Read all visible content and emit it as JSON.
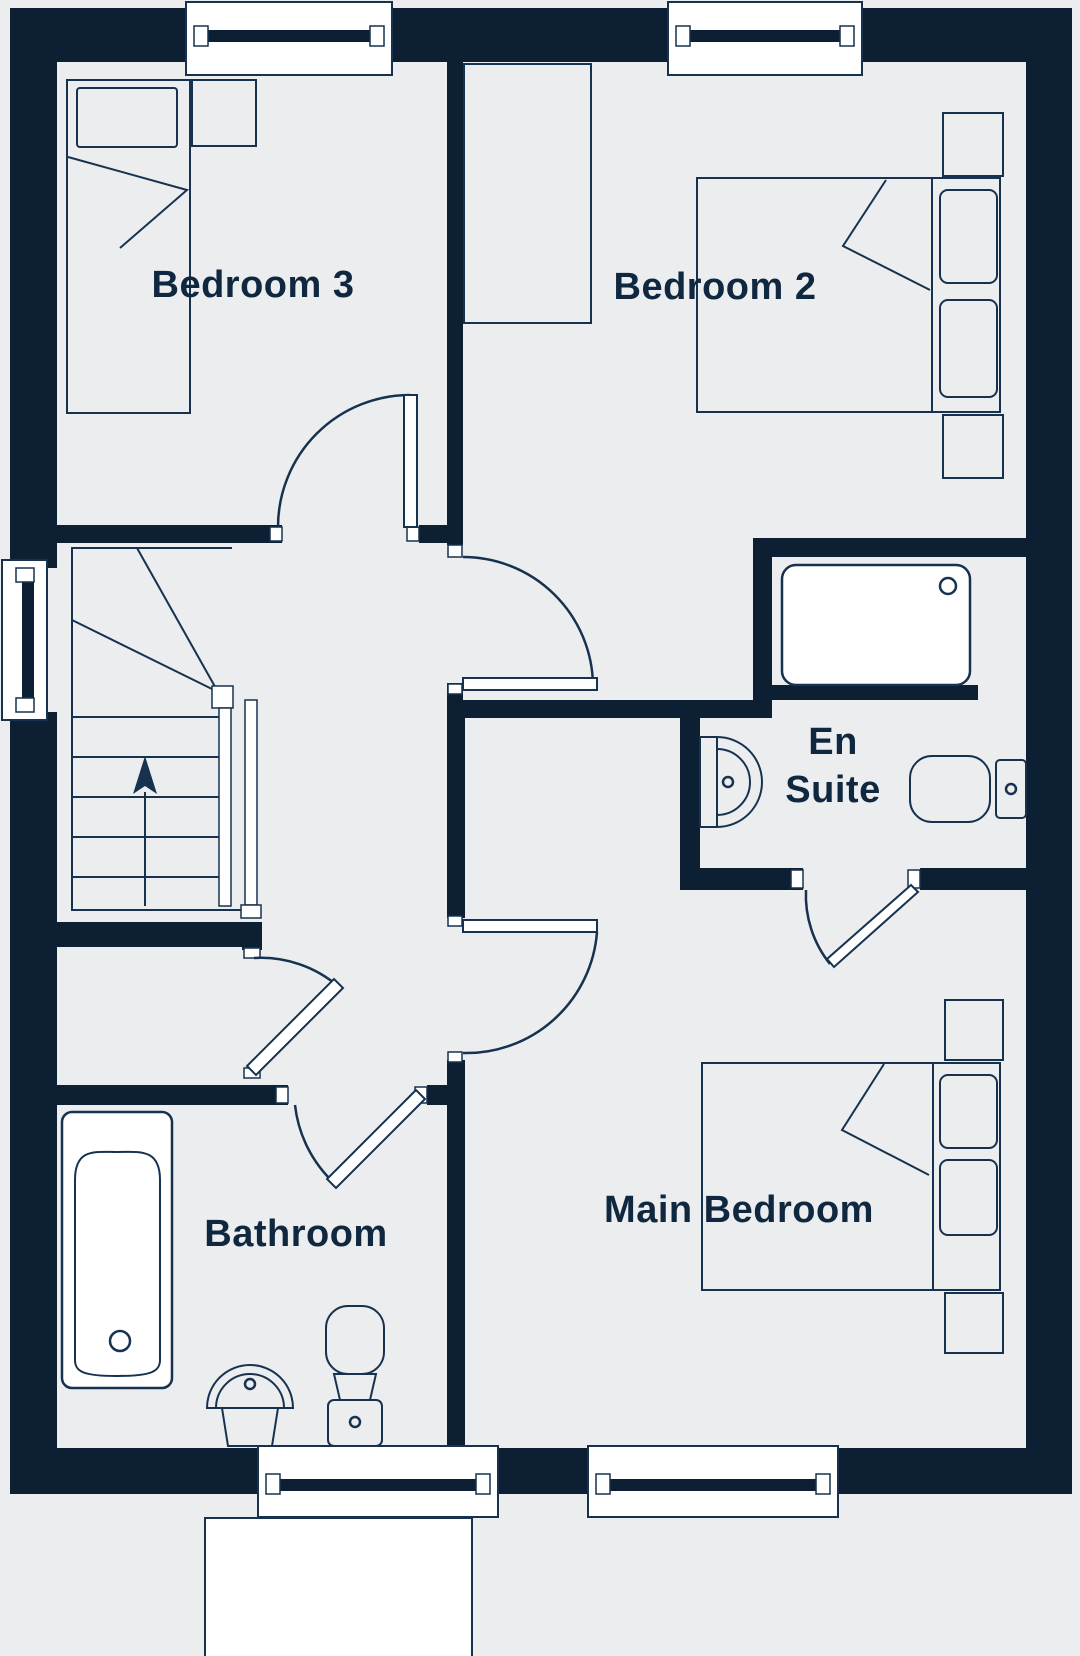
{
  "plan": {
    "type": "floor-plan",
    "floor": "bedroom level",
    "colors": {
      "wall": "#0d1f33",
      "line": "#16324f",
      "text": "#0f2840",
      "floor": "#ecedef",
      "window": "#ffffff"
    }
  },
  "rooms": {
    "bedroom3": {
      "label": "Bedroom 3"
    },
    "bedroom2": {
      "label": "Bedroom 2"
    },
    "ensuite": {
      "label_line1": "En",
      "label_line2": "Suite"
    },
    "bathroom": {
      "label": "Bathroom"
    },
    "main_bedroom": {
      "label": "Main Bedroom"
    }
  },
  "stairs": {
    "direction": "up",
    "winders": 2,
    "straight_treads": 5
  },
  "windows": [
    {
      "location": "bedroom3-top"
    },
    {
      "location": "bedroom2-top"
    },
    {
      "location": "stairs-left"
    },
    {
      "location": "bathroom-bottom"
    },
    {
      "location": "main-bedroom-bottom"
    }
  ],
  "doors": [
    {
      "room": "bedroom3"
    },
    {
      "room": "bedroom2"
    },
    {
      "room": "main-bedroom"
    },
    {
      "room": "bathroom"
    },
    {
      "room": "ensuite"
    },
    {
      "room": "cupboard"
    }
  ],
  "fixtures": {
    "bathroom": [
      "bathtub",
      "pedestal-sink",
      "toilet"
    ],
    "ensuite": [
      "shower-tray",
      "pedestal-sink",
      "toilet"
    ],
    "bedroom3": [
      "single-bed",
      "bedside-table"
    ],
    "bedroom2": [
      "double-bed",
      "two-pillows",
      "two-bedside-tables",
      "wardrobe"
    ],
    "main_bedroom": [
      "double-bed",
      "two-pillows",
      "two-bedside-tables"
    ]
  }
}
